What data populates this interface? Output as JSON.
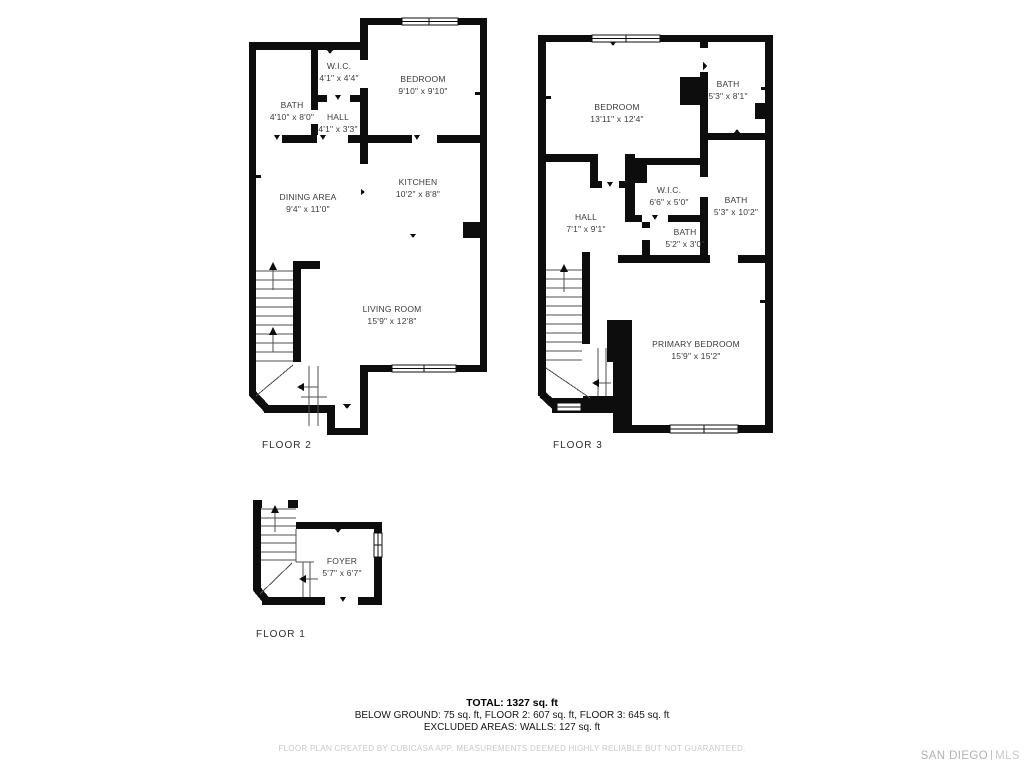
{
  "floors": [
    {
      "label": "FLOOR 2",
      "rooms": [
        {
          "name": "W.I.C.",
          "dims": "4'1\" x 4'4\""
        },
        {
          "name": "BEDROOM",
          "dims": "9'10\" x 9'10\""
        },
        {
          "name": "BATH",
          "dims": "4'10\" x 8'0\""
        },
        {
          "name": "HALL",
          "dims": "4'1\" x 3'3\""
        },
        {
          "name": "KITCHEN",
          "dims": "10'2\" x 8'8\""
        },
        {
          "name": "DINING AREA",
          "dims": "9'4\" x 11'0\""
        },
        {
          "name": "LIVING ROOM",
          "dims": "15'9\" x 12'8\""
        }
      ]
    },
    {
      "label": "FLOOR 3",
      "rooms": [
        {
          "name": "BEDROOM",
          "dims": "13'11\" x 12'4\""
        },
        {
          "name": "BATH",
          "dims": "5'3\" x 8'1\""
        },
        {
          "name": "W.I.C.",
          "dims": "6'6\" x 5'0\""
        },
        {
          "name": "BATH",
          "dims": "5'3\" x 10'2\""
        },
        {
          "name": "HALL",
          "dims": "7'1\" x 9'1\""
        },
        {
          "name": "BATH",
          "dims": "5'2\" x 3'0\""
        },
        {
          "name": "PRIMARY BEDROOM",
          "dims": "15'9\" x 15'2\""
        }
      ]
    },
    {
      "label": "FLOOR 1",
      "rooms": [
        {
          "name": "FOYER",
          "dims": "5'7\" x 6'7\""
        }
      ]
    }
  ],
  "summary": {
    "total": "TOTAL: 1327 sq. ft",
    "breakdown": "BELOW GROUND: 75 sq. ft, FLOOR 2: 607 sq. ft, FLOOR 3: 645 sq. ft",
    "excluded": "EXCLUDED AREAS: WALLS: 127 sq. ft",
    "disclaimer": "FLOOR PLAN CREATED BY CUBICASA APP. MEASUREMENTS DEEMED HIGHLY RELIABLE BUT NOT GUARANTEED."
  },
  "watermark": {
    "brand": "SAN DIEGO",
    "suffix": "MLS"
  },
  "colors": {
    "wall": "#0d0d0d",
    "room_text": "#3b3b3b",
    "stair_lines": "#4f4f4f",
    "disclaimer_text": "#c9c9c9",
    "watermark_text": "#b3b1b1",
    "background": "#ffffff"
  }
}
